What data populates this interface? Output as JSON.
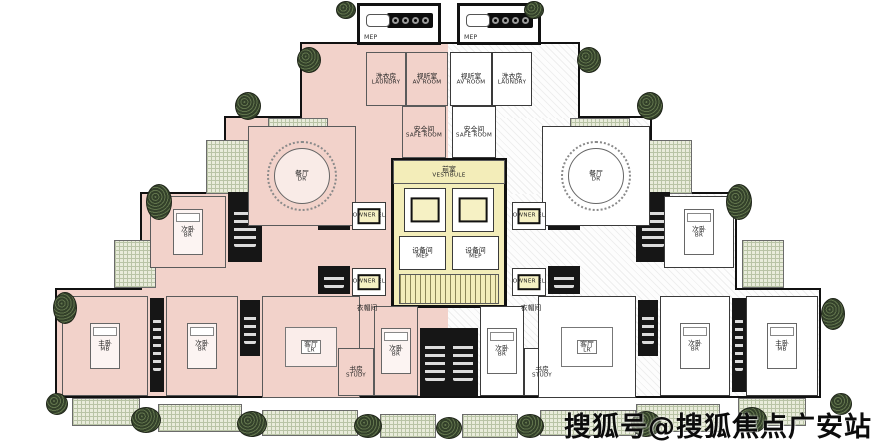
{
  "watermark": {
    "text": "搜狐号@搜狐焦点广安站"
  },
  "colors": {
    "paper": "#ffffff",
    "pink": "#f2d2ca",
    "yellow": "#f3edb9",
    "wall": "#161616",
    "terrace": "#e9ecdb",
    "planter": "#3c4c2f",
    "ink": "#111111"
  },
  "blocks": [
    {
      "x": 55,
      "y": 288,
      "w": 766,
      "h": 110
    },
    {
      "x": 140,
      "y": 192,
      "w": 597,
      "h": 100
    },
    {
      "x": 224,
      "y": 116,
      "w": 428,
      "h": 80
    },
    {
      "x": 300,
      "y": 42,
      "w": 280,
      "h": 78
    }
  ],
  "tints": [
    {
      "x": 57,
      "y": 290,
      "w": 391,
      "h": 106,
      "fill": "pink"
    },
    {
      "x": 448,
      "y": 290,
      "w": 371,
      "h": 106,
      "fill": "hatch"
    },
    {
      "x": 142,
      "y": 194,
      "w": 306,
      "h": 96,
      "fill": "pink"
    },
    {
      "x": 448,
      "y": 194,
      "w": 287,
      "h": 96,
      "fill": "hatch"
    },
    {
      "x": 226,
      "y": 118,
      "w": 222,
      "h": 76,
      "fill": "pink"
    },
    {
      "x": 448,
      "y": 118,
      "w": 202,
      "h": 76,
      "fill": "hatch"
    },
    {
      "x": 302,
      "y": 44,
      "w": 146,
      "h": 74,
      "fill": "pink"
    },
    {
      "x": 448,
      "y": 44,
      "w": 130,
      "h": 74,
      "fill": "hatch"
    }
  ],
  "terraces": [
    {
      "x": 268,
      "y": 118,
      "w": 60,
      "h": 14
    },
    {
      "x": 570,
      "y": 118,
      "w": 60,
      "h": 14
    },
    {
      "x": 206,
      "y": 140,
      "w": 44,
      "h": 54
    },
    {
      "x": 648,
      "y": 140,
      "w": 44,
      "h": 54
    },
    {
      "x": 114,
      "y": 240,
      "w": 42,
      "h": 48
    },
    {
      "x": 742,
      "y": 240,
      "w": 42,
      "h": 48
    },
    {
      "x": 72,
      "y": 398,
      "w": 68,
      "h": 28
    },
    {
      "x": 158,
      "y": 404,
      "w": 84,
      "h": 28
    },
    {
      "x": 262,
      "y": 410,
      "w": 96,
      "h": 26
    },
    {
      "x": 380,
      "y": 414,
      "w": 56,
      "h": 24
    },
    {
      "x": 462,
      "y": 414,
      "w": 56,
      "h": 24
    },
    {
      "x": 540,
      "y": 410,
      "w": 96,
      "h": 26
    },
    {
      "x": 636,
      "y": 404,
      "w": 84,
      "h": 28
    },
    {
      "x": 738,
      "y": 398,
      "w": 68,
      "h": 28
    }
  ],
  "cores": [
    {
      "x": 228,
      "y": 192,
      "w": 34,
      "h": 70
    },
    {
      "x": 636,
      "y": 192,
      "w": 34,
      "h": 70
    },
    {
      "x": 318,
      "y": 202,
      "w": 32,
      "h": 28
    },
    {
      "x": 318,
      "y": 266,
      "w": 32,
      "h": 28
    },
    {
      "x": 548,
      "y": 202,
      "w": 32,
      "h": 28
    },
    {
      "x": 548,
      "y": 266,
      "w": 32,
      "h": 28
    },
    {
      "x": 420,
      "y": 328,
      "w": 30,
      "h": 68
    },
    {
      "x": 448,
      "y": 328,
      "w": 30,
      "h": 68
    },
    {
      "x": 150,
      "y": 298,
      "w": 14,
      "h": 94
    },
    {
      "x": 732,
      "y": 298,
      "w": 14,
      "h": 94
    },
    {
      "x": 240,
      "y": 300,
      "w": 20,
      "h": 56
    },
    {
      "x": 638,
      "y": 300,
      "w": 20,
      "h": 56
    }
  ],
  "core_bg": {
    "x": 391,
    "y": 158,
    "w": 116,
    "h": 150
  },
  "rooms": [
    {
      "n": "laundry-room-left",
      "cn": "洗衣房",
      "en": "LAUNDRY",
      "x": 366,
      "y": 52,
      "w": 40,
      "h": 54,
      "fill": "pink"
    },
    {
      "n": "av-room-left",
      "cn": "视听室",
      "en": "AV ROOM",
      "x": 406,
      "y": 52,
      "w": 42,
      "h": 54,
      "fill": "pink"
    },
    {
      "n": "av-room-right",
      "cn": "视听室",
      "en": "AV ROOM",
      "x": 450,
      "y": 52,
      "w": 42,
      "h": 54,
      "fill": "white"
    },
    {
      "n": "laundry-room-right",
      "cn": "洗衣房",
      "en": "LAUNDRY",
      "x": 492,
      "y": 52,
      "w": 40,
      "h": 54,
      "fill": "white"
    },
    {
      "n": "safe-room-left",
      "cn": "安全间",
      "en": "SAFE ROOM",
      "x": 402,
      "y": 106,
      "w": 44,
      "h": 52,
      "fill": "pink"
    },
    {
      "n": "safe-room-right",
      "cn": "安全间",
      "en": "SAFE ROOM",
      "x": 452,
      "y": 106,
      "w": 44,
      "h": 52,
      "fill": "white"
    },
    {
      "n": "dining-room-left",
      "cn": "餐厅",
      "en": "DR",
      "x": 248,
      "y": 126,
      "w": 108,
      "h": 100,
      "fill": "pink",
      "f": "table"
    },
    {
      "n": "dining-room-right",
      "cn": "餐厅",
      "en": "DR",
      "x": 542,
      "y": 126,
      "w": 108,
      "h": 100,
      "fill": "white",
      "f": "table"
    },
    {
      "n": "bedroom-left-mid",
      "cn": "次卧",
      "en": "BR",
      "x": 150,
      "y": 196,
      "w": 76,
      "h": 72,
      "fill": "pink",
      "f": "bed"
    },
    {
      "n": "bedroom-right-mid",
      "cn": "次卧",
      "en": "BR",
      "x": 664,
      "y": 196,
      "w": 70,
      "h": 72,
      "fill": "white",
      "f": "bed"
    },
    {
      "n": "owner-elevator-left-1",
      "cn": "",
      "en": "OWNER EL",
      "x": 352,
      "y": 202,
      "w": 34,
      "h": 28,
      "fill": "white",
      "f": "elev"
    },
    {
      "n": "owner-elevator-left-2",
      "cn": "",
      "en": "OWNER EL",
      "x": 352,
      "y": 268,
      "w": 34,
      "h": 28,
      "fill": "white",
      "f": "elev"
    },
    {
      "n": "owner-elevator-right-1",
      "cn": "",
      "en": "OWNER EL",
      "x": 512,
      "y": 202,
      "w": 34,
      "h": 28,
      "fill": "white",
      "f": "elev"
    },
    {
      "n": "owner-elevator-right-2",
      "cn": "",
      "en": "OWNER EL",
      "x": 512,
      "y": 268,
      "w": 34,
      "h": 28,
      "fill": "white",
      "f": "elev"
    },
    {
      "n": "vestibule",
      "cn": "前室",
      "en": "VESTIBULE",
      "x": 393,
      "y": 160,
      "w": 112,
      "h": 24,
      "fill": "yellow"
    },
    {
      "n": "elevator-1",
      "cn": "",
      "en": "",
      "x": 404,
      "y": 188,
      "w": 42,
      "h": 44,
      "fill": "white",
      "f": "elev"
    },
    {
      "n": "elevator-2",
      "cn": "",
      "en": "",
      "x": 452,
      "y": 188,
      "w": 42,
      "h": 44,
      "fill": "white",
      "f": "elev"
    },
    {
      "n": "mep-room-1",
      "cn": "设备间",
      "en": "MEP",
      "x": 399,
      "y": 236,
      "w": 47,
      "h": 34,
      "fill": "white"
    },
    {
      "n": "mep-room-2",
      "cn": "设备间",
      "en": "MEP",
      "x": 452,
      "y": 236,
      "w": 47,
      "h": 34,
      "fill": "white"
    },
    {
      "n": "stair-core",
      "cn": "",
      "en": "",
      "x": 399,
      "y": 274,
      "w": 100,
      "h": 30,
      "fill": "yellow",
      "f": "stairs"
    },
    {
      "n": "master-bedroom-left",
      "cn": "主卧",
      "en": "MB",
      "x": 62,
      "y": 296,
      "w": 86,
      "h": 100,
      "fill": "pink",
      "f": "bed"
    },
    {
      "n": "bedroom-left-bottom",
      "cn": "次卧",
      "en": "BR",
      "x": 166,
      "y": 296,
      "w": 72,
      "h": 100,
      "fill": "pink",
      "f": "bed"
    },
    {
      "n": "living-room-left",
      "cn": "客厅",
      "en": "LR",
      "x": 262,
      "y": 296,
      "w": 98,
      "h": 102,
      "fill": "pink",
      "f": "sofa"
    },
    {
      "n": "closet-left",
      "cn": "衣帽间",
      "en": "",
      "x": 346,
      "y": 300,
      "w": 42,
      "h": 16,
      "fill": "plain"
    },
    {
      "n": "study-left",
      "cn": "书房",
      "en": "STUDY",
      "x": 338,
      "y": 348,
      "w": 36,
      "h": 48,
      "fill": "pink"
    },
    {
      "n": "bedroom-center-left",
      "cn": "次卧",
      "en": "BR",
      "x": 374,
      "y": 306,
      "w": 44,
      "h": 90,
      "fill": "pink",
      "f": "bed"
    },
    {
      "n": "bedroom-center-right",
      "cn": "次卧",
      "en": "BR",
      "x": 480,
      "y": 306,
      "w": 44,
      "h": 90,
      "fill": "white",
      "f": "bed"
    },
    {
      "n": "study-right",
      "cn": "书房",
      "en": "STUDY",
      "x": 524,
      "y": 348,
      "w": 36,
      "h": 48,
      "fill": "white"
    },
    {
      "n": "closet-right",
      "cn": "衣帽间",
      "en": "",
      "x": 510,
      "y": 300,
      "w": 42,
      "h": 16,
      "fill": "plain"
    },
    {
      "n": "living-room-right",
      "cn": "客厅",
      "en": "LR",
      "x": 538,
      "y": 296,
      "w": 98,
      "h": 102,
      "fill": "white",
      "f": "sofa"
    },
    {
      "n": "bedroom-right-bottom",
      "cn": "次卧",
      "en": "BR",
      "x": 660,
      "y": 296,
      "w": 70,
      "h": 100,
      "fill": "white",
      "f": "bed"
    },
    {
      "n": "master-bedroom-right",
      "cn": "主卧",
      "en": "MB",
      "x": 746,
      "y": 296,
      "w": 72,
      "h": 100,
      "fill": "white",
      "f": "bed"
    }
  ],
  "kitchens": [
    {
      "n": "kitchen-left",
      "label": "MEP",
      "x": 357,
      "y": 3,
      "w": 84,
      "h": 42
    },
    {
      "n": "kitchen-right",
      "label": "MEP",
      "x": 457,
      "y": 3,
      "w": 84,
      "h": 42
    }
  ],
  "planters": [
    {
      "x": 346,
      "y": 10,
      "rx": 10,
      "ry": 9
    },
    {
      "x": 534,
      "y": 10,
      "rx": 10,
      "ry": 9
    },
    {
      "x": 309,
      "y": 60,
      "rx": 12,
      "ry": 13
    },
    {
      "x": 589,
      "y": 60,
      "rx": 12,
      "ry": 13
    },
    {
      "x": 248,
      "y": 106,
      "rx": 13,
      "ry": 14
    },
    {
      "x": 650,
      "y": 106,
      "rx": 13,
      "ry": 14
    },
    {
      "x": 159,
      "y": 202,
      "rx": 13,
      "ry": 18
    },
    {
      "x": 739,
      "y": 202,
      "rx": 13,
      "ry": 18
    },
    {
      "x": 65,
      "y": 308,
      "rx": 12,
      "ry": 16
    },
    {
      "x": 833,
      "y": 314,
      "rx": 12,
      "ry": 16
    },
    {
      "x": 57,
      "y": 404,
      "rx": 11,
      "ry": 11
    },
    {
      "x": 841,
      "y": 404,
      "rx": 11,
      "ry": 11
    },
    {
      "x": 146,
      "y": 420,
      "rx": 15,
      "ry": 13
    },
    {
      "x": 252,
      "y": 424,
      "rx": 15,
      "ry": 13
    },
    {
      "x": 368,
      "y": 426,
      "rx": 14,
      "ry": 12
    },
    {
      "x": 449,
      "y": 428,
      "rx": 13,
      "ry": 11
    },
    {
      "x": 530,
      "y": 426,
      "rx": 14,
      "ry": 12
    },
    {
      "x": 646,
      "y": 424,
      "rx": 15,
      "ry": 13
    },
    {
      "x": 752,
      "y": 420,
      "rx": 15,
      "ry": 13
    }
  ]
}
